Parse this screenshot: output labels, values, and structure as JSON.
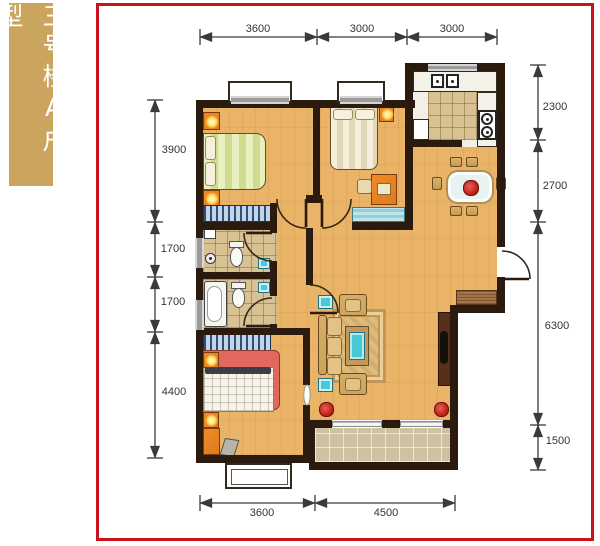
{
  "badge": {
    "text": "三号楼A户型"
  },
  "dimensions": {
    "top": [
      "3600",
      "3000",
      "3000"
    ],
    "left": [
      "3900",
      "1700",
      "1700",
      "4400"
    ],
    "right": [
      "2300",
      "2700",
      "6300",
      "1500"
    ],
    "bottom": [
      "3600",
      "4500"
    ]
  },
  "plan": {
    "type": "apartment-floor-plan",
    "rooms": [
      "bedroom-top-left",
      "bedroom-top-middle",
      "kitchen",
      "dining-area",
      "bathroom-upper",
      "bathroom-lower",
      "hallway",
      "living-room",
      "bedroom-bottom-left",
      "balcony"
    ],
    "furniture_icons": [
      "bed-icon",
      "nightstand-lamp-icon",
      "wardrobe-icon",
      "toilet-icon",
      "bathtub-icon",
      "shower-icon",
      "wash-basin-icon",
      "kitchen-sink-icon",
      "stove-icon",
      "fridge-icon",
      "dining-table-icon",
      "dining-chair-icon",
      "sofa-icon",
      "armchair-icon",
      "coffee-table-icon",
      "rug-icon",
      "tv-cabinet-icon",
      "potted-plant-icon",
      "doormat-icon",
      "desk-icon",
      "stool-icon",
      "door-swing-icon",
      "window-icon",
      "sliding-door-icon"
    ]
  },
  "colors": {
    "frame_red": "#c8121c",
    "badge_gold": "#cba45e",
    "wall_dark": "#2b1a0e",
    "wood_floor": "#e9b468",
    "tile_tan": "#d8c193",
    "balcony_tile": "#cdc3a4",
    "furniture_orange": "#e07b1e",
    "teal_accent": "#49c8d8",
    "sofa_tan": "#cba45e",
    "rug_tan": "#dcbc7c",
    "dim_line": "#3a3a3a"
  }
}
